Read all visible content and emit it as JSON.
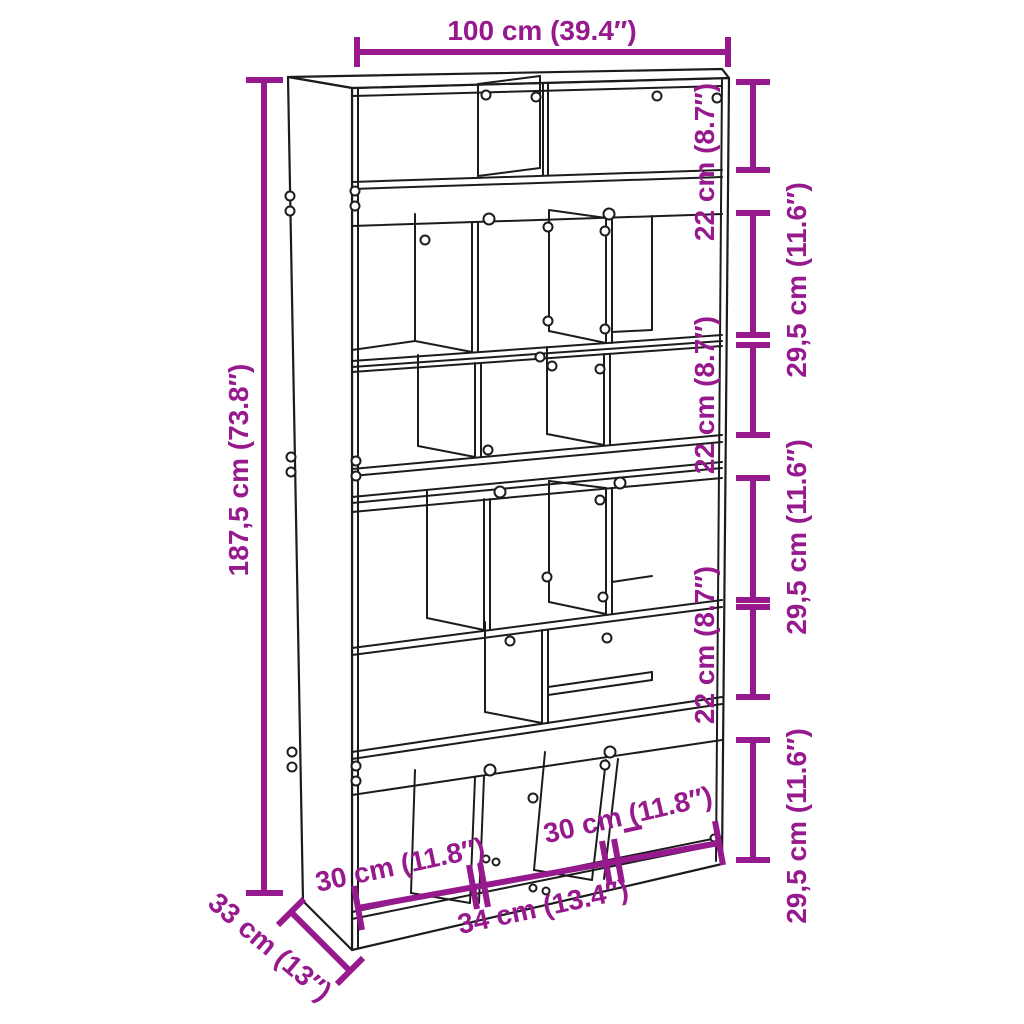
{
  "colors": {
    "dimension_magenta": "#97198E",
    "outline_black": "#1C1C1C",
    "background": "#FFFFFF"
  },
  "dimensions": {
    "top_width": "100 cm (39.4″)",
    "left_height": "187,5 cm (73.8″)",
    "right_segments": [
      {
        "label": "22 cm (8.7″)"
      },
      {
        "label": "29,5 cm (11.6″)"
      },
      {
        "label": "22 cm (8.7″)"
      },
      {
        "label": "29,5 cm (11.6″)"
      },
      {
        "label": "22 cm (8.7″)"
      },
      {
        "label": "29,5 cm (11.6″)"
      }
    ],
    "bottom_widths": {
      "left": "30 cm (11.8″)",
      "center": "34 cm (13.4″)",
      "right": "30 cm (11.8″)"
    },
    "depth": "33 cm (13″)"
  }
}
